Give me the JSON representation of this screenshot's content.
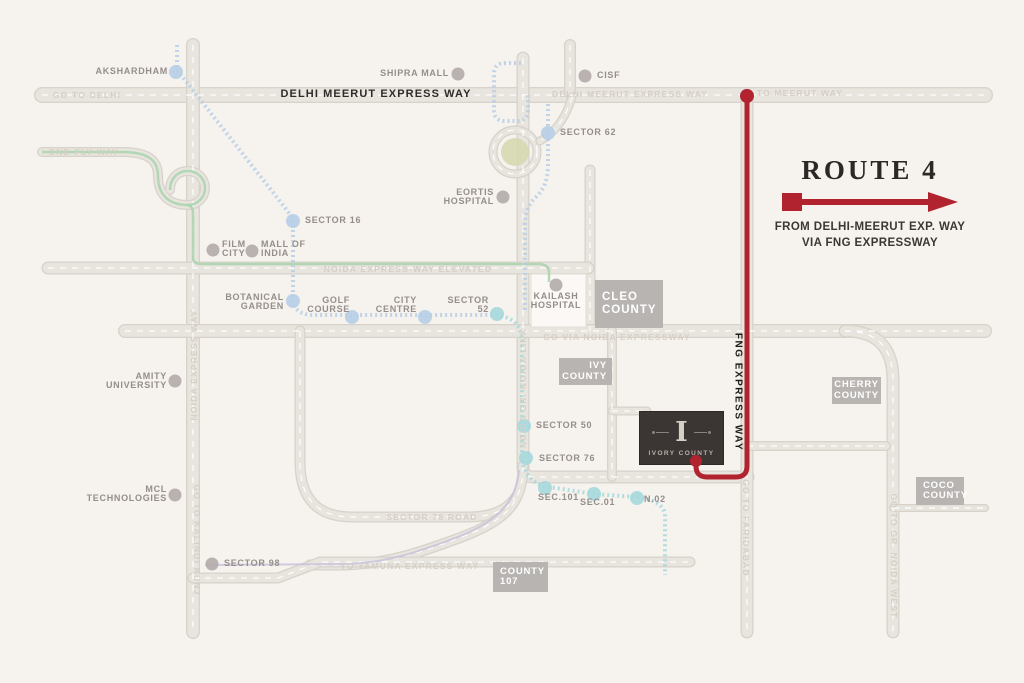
{
  "title_panel": {
    "title": "ROUTE 4",
    "line1": "FROM DELHI-MEERUT EXP. WAY",
    "line2": "VIA FNG EXPRESSWAY"
  },
  "colors": {
    "background": "#f6f2ee",
    "road_fill": "#e8e4de",
    "road_casing": "#d7d2ca",
    "route_red": "#b0232f",
    "metro_blue": "#b7cfe5",
    "metro_teal": "#a6d9dc",
    "line_green": "#a6d3ab",
    "line_lavender": "#c9c3da",
    "dot_gray": "#b3acaa",
    "box_gray": "#b8b4b2",
    "project_dark": "#3b3534",
    "roundabout_green": "#d5d8ae"
  },
  "map": {
    "road_labels": {
      "delhi_meerut": "DELHI MEERUT EXPRESS WAY",
      "fng": "FNG EXPRESS WAY"
    },
    "roads": [
      {
        "d": "M42 95 H985",
        "w": 16
      },
      {
        "d": "M193 45 V632",
        "w": 14
      },
      {
        "d": "M570 45 V93",
        "w": 12
      },
      {
        "d": "M523 58 V468 Q523 477 534 477 H748",
        "w": 13
      },
      {
        "d": "M590 170 V331",
        "w": 11
      },
      {
        "d": "M48 268 H588",
        "w": 13
      },
      {
        "d": "M125 331 H985",
        "w": 14
      },
      {
        "d": "M845 331 Q893 331 893 380 V632",
        "w": 13
      },
      {
        "d": "M612 331 V477",
        "w": 10
      },
      {
        "d": "M612 411 H647",
        "w": 9
      },
      {
        "d": "M747 95 V632",
        "w": 13
      },
      {
        "d": "M747 446 H886",
        "w": 10
      },
      {
        "d": "M893 508 H985",
        "w": 8
      },
      {
        "d": "M300 331 V462 Q300 517 352 517 H468 Q502 517 515 498",
        "w": 11
      },
      {
        "d": "M523 466 C523 505 503 521 462 537 C424 551 392 563 346 565 H310",
        "w": 11
      },
      {
        "d": "M193 578 H278 L320 562 H690",
        "w": 11
      },
      {
        "d": "M42 152 H122 C148 152 158 160 158 176 C158 194 168 205 188 205 A17 17 0 1 0 188 171 C177 171 170 179 170 190",
        "w": 10
      },
      {
        "d": "M537 152 A22 22 0 1 0 493 152 A22 22 0 1 0 537 152",
        "w": 9
      },
      {
        "d": "M572 97 Q563 128 540 141",
        "w": 9
      }
    ],
    "blocks": [
      {
        "x": 531,
        "y": 274,
        "w": 55,
        "h": 53
      }
    ],
    "roundabout": {
      "cx": 515,
      "cy": 152,
      "r": 14
    },
    "overlays": [
      {
        "d": "M42 152 H122 C148 152 158 160 158 176 C158 194 168 205 188 205 A17 17 0 1 0 188 171 C177 171 170 179 170 190",
        "color": "green",
        "w": 2.5,
        "dash": ""
      },
      {
        "d": "M188 205 Q193 206 193 214 V258 Q193 264 202 264 H538 Q549 264 549 272 V282",
        "color": "green",
        "w": 2.5,
        "dash": ""
      },
      {
        "d": "M177 45 V70 L293 218 V298 Q293 314 312 315 H478 Q492 315 496 314",
        "color": "blue",
        "w": 4,
        "dash": "2 3"
      },
      {
        "d": "M521 63 H505 Q494 63 494 74 V110 Q494 121 505 121 H517 Q528 121 528 110 V93",
        "color": "blue",
        "w": 4,
        "dash": "2 3"
      },
      {
        "d": "M548 104 V165 Q548 186 536 197 Q525 207 525 225 V312",
        "color": "blue",
        "w": 4,
        "dash": "2 3"
      },
      {
        "d": "M496 315 Q522 318 522 342 V455 Q522 478 543 486 L594 494 L637 497 Q662 500 665 514 V575",
        "color": "teal",
        "w": 4,
        "dash": "2 3"
      },
      {
        "d": "M519 470 C516 504 497 521 458 537 C420 551 392 562 348 564 L205 565",
        "color": "lavender",
        "w": 2,
        "dash": ""
      }
    ],
    "route": {
      "d": "M747 96 V466 Q747 477 736 477 H707 Q696 477 696 466 V461",
      "start_dot": {
        "x": 747,
        "y": 96,
        "r": 7
      },
      "end_dot": {
        "x": 696,
        "y": 461,
        "r": 6
      }
    },
    "landmarks": [
      {
        "lines": [
          "AKSHARDHAM"
        ],
        "dot": [
          176,
          72
        ],
        "c": "blue",
        "tx": 168,
        "ty": 67,
        "anchor": "end"
      },
      {
        "lines": [
          "SHIPRA MALL"
        ],
        "dot": [
          458,
          74
        ],
        "c": "gray",
        "tx": 449,
        "ty": 69,
        "anchor": "end"
      },
      {
        "lines": [
          "CISF"
        ],
        "dot": [
          585,
          76
        ],
        "c": "gray",
        "tx": 597,
        "ty": 71,
        "anchor": "start"
      },
      {
        "lines": [
          "SECTOR 62"
        ],
        "dot": [
          548,
          133
        ],
        "c": "blue",
        "tx": 560,
        "ty": 128,
        "anchor": "start"
      },
      {
        "lines": [
          "EORTIS",
          "HOSPITAL"
        ],
        "dot": [
          503,
          197
        ],
        "c": "gray",
        "tx": 494,
        "ty": 188,
        "anchor": "end"
      },
      {
        "lines": [
          "SECTOR 16"
        ],
        "dot": [
          293,
          221
        ],
        "c": "blue",
        "tx": 305,
        "ty": 216,
        "anchor": "start"
      },
      {
        "lines": [
          "FILM",
          "CITY"
        ],
        "dot": [
          213,
          250
        ],
        "c": "gray",
        "tx": 222,
        "ty": 240,
        "anchor": "start"
      },
      {
        "lines": [
          "MALL OF",
          "INDIA"
        ],
        "dot": [
          252,
          251
        ],
        "c": "gray",
        "tx": 261,
        "ty": 240,
        "anchor": "start"
      },
      {
        "lines": [
          "BOTANICAL",
          "GARDEN"
        ],
        "dot": [
          293,
          301
        ],
        "c": "blue",
        "tx": 284,
        "ty": 293,
        "anchor": "end"
      },
      {
        "lines": [
          "GOLF",
          "COURSE"
        ],
        "dot": [
          352,
          317
        ],
        "c": "blue",
        "tx": 350,
        "ty": 296,
        "anchor": "end"
      },
      {
        "lines": [
          "CITY",
          "CENTRE"
        ],
        "dot": [
          425,
          317
        ],
        "c": "blue",
        "tx": 417,
        "ty": 296,
        "anchor": "end"
      },
      {
        "lines": [
          "SECTOR",
          "52"
        ],
        "dot": [
          497,
          314
        ],
        "c": "teal",
        "tx": 489,
        "ty": 296,
        "anchor": "end"
      },
      {
        "lines": [
          "KAILASH",
          "HOSPITAL"
        ],
        "dot": [
          556,
          285
        ],
        "c": "gray",
        "tx": 556,
        "ty": 292,
        "anchor": "middle"
      },
      {
        "lines": [
          "AMITY",
          "UNIVERSITY"
        ],
        "dot": [
          175,
          381
        ],
        "c": "gray",
        "tx": 167,
        "ty": 372,
        "anchor": "end"
      },
      {
        "lines": [
          "SECTOR 50"
        ],
        "dot": [
          524,
          426
        ],
        "c": "teal",
        "tx": 536,
        "ty": 421,
        "anchor": "start"
      },
      {
        "lines": [
          "SECTOR 76"
        ],
        "dot": [
          526,
          458
        ],
        "c": "teal",
        "tx": 539,
        "ty": 454,
        "anchor": "start"
      },
      {
        "lines": [
          "SEC.101"
        ],
        "dot": [
          545,
          488
        ],
        "c": "teal",
        "tx": 538,
        "ty": 493,
        "anchor": "start"
      },
      {
        "lines": [
          "SEC.01"
        ],
        "dot": [
          594,
          494
        ],
        "c": "teal",
        "tx": 580,
        "ty": 498,
        "anchor": "start"
      },
      {
        "lines": [
          "N.02"
        ],
        "dot": [
          637,
          498
        ],
        "c": "teal",
        "tx": 644,
        "ty": 495,
        "anchor": "start"
      },
      {
        "lines": [
          "MCL",
          "TECHNOLOGIES"
        ],
        "dot": [
          175,
          495
        ],
        "c": "gray",
        "tx": 167,
        "ty": 485,
        "anchor": "end"
      },
      {
        "lines": [
          "SECTOR 98"
        ],
        "dot": [
          212,
          564
        ],
        "c": "gray",
        "tx": 224,
        "ty": 559,
        "anchor": "start"
      }
    ],
    "county_boxes": [
      {
        "lines": [
          "CLEO",
          "COUNTY"
        ],
        "x": 595,
        "y": 280,
        "w": 68,
        "h": 48,
        "align": "left",
        "big": true
      },
      {
        "lines": [
          "IVY",
          "COUNTY"
        ],
        "x": 559,
        "y": 358,
        "w": 53,
        "h": 27,
        "align": "right",
        "big": false
      },
      {
        "lines": [
          "CHERRY",
          "COUNTY"
        ],
        "x": 832,
        "y": 377,
        "w": 49,
        "h": 27,
        "align": "center",
        "big": false
      },
      {
        "lines": [
          "COCO",
          "COUNTY"
        ],
        "x": 916,
        "y": 477,
        "w": 48,
        "h": 28,
        "align": "left",
        "big": false
      },
      {
        "lines": [
          "COUNTY",
          "107"
        ],
        "x": 493,
        "y": 562,
        "w": 55,
        "h": 30,
        "align": "left",
        "big": false
      }
    ],
    "ghost_labels": [
      {
        "text": "GO TO DELHI",
        "cx": 87,
        "cy": 95,
        "rot": 0
      },
      {
        "text": "DELHI MEERUT EXPRESS WAY",
        "cx": 630,
        "cy": 94,
        "rot": 0
      },
      {
        "text": "TO MEERUT WAY",
        "cx": 800,
        "cy": 93,
        "rot": 0
      },
      {
        "text": "DND FLY WAY",
        "cx": 84,
        "cy": 152,
        "rot": 0
      },
      {
        "text": "NOIDA EXPRESS-WAY ELEVATED",
        "cx": 408,
        "cy": 269,
        "rot": 0
      },
      {
        "text": "GO VIA NOIDA EXPRESSWAY",
        "cx": 617,
        "cy": 337,
        "rot": 0
      },
      {
        "text": "NOIDA EXPRESS WAY",
        "cx": 194,
        "cy": 365,
        "rot": -90
      },
      {
        "text": "NOIDA GR. NOIDA LINK",
        "cx": 523,
        "cy": 388,
        "rot": -90
      },
      {
        "text": "GO TO GR. NOIDA WEST",
        "cx": 894,
        "cy": 556,
        "rot": 90
      },
      {
        "text": "GO TO KALINDI KUNJ",
        "cx": 197,
        "cy": 540,
        "rot": 90
      },
      {
        "text": "SECTOR 78 ROAD",
        "cx": 432,
        "cy": 517,
        "rot": 0
      },
      {
        "text": "TO YAMUNA EXPRESS WAY",
        "cx": 410,
        "cy": 566,
        "rot": 0
      },
      {
        "text": "GO TO FARIDABAD",
        "cx": 746,
        "cy": 528,
        "rot": 90
      }
    ],
    "project": {
      "x": 640,
      "y": 412,
      "w": 83,
      "h": 52,
      "logo": "I",
      "name": "IVORY COUNTY"
    },
    "fng_label_pos": {
      "cx": 738,
      "cy": 392
    },
    "delhi_meerut_label_pos": {
      "cx": 376,
      "cy": 94
    }
  }
}
